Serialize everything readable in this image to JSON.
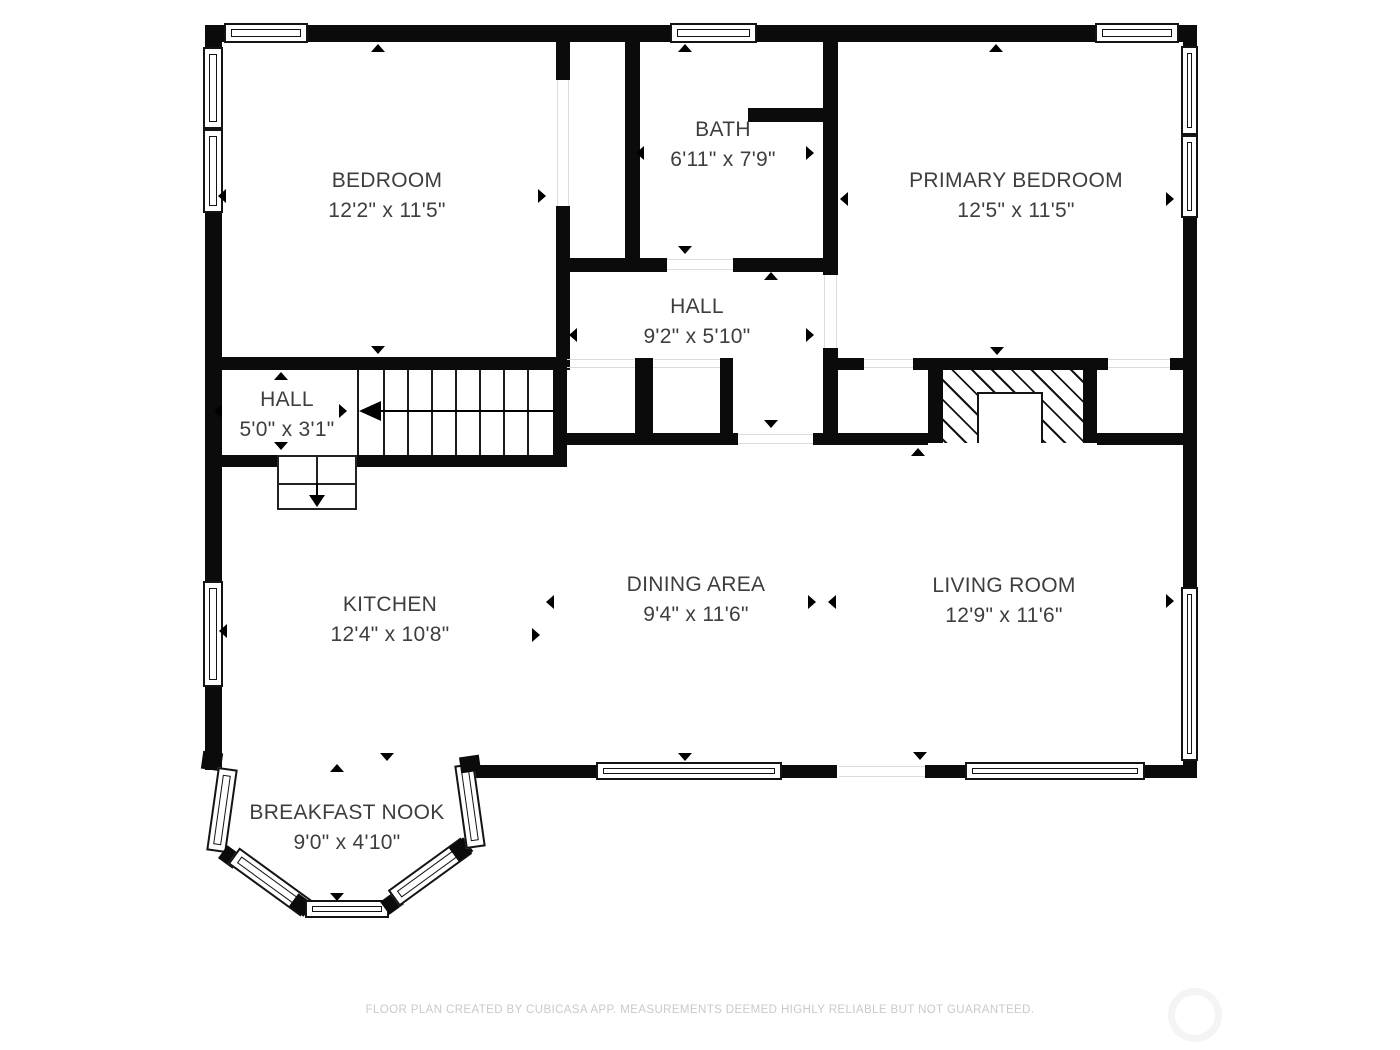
{
  "plan": {
    "type": "floor-plan",
    "creator_app": "CubiCasa"
  },
  "rooms": [
    {
      "id": "bedroom",
      "name": "BEDROOM",
      "dims": "12'2\" x 11'5\""
    },
    {
      "id": "bath",
      "name": "BATH",
      "dims": "6'11\" x 7'9\""
    },
    {
      "id": "primary-bedroom",
      "name": "PRIMARY BEDROOM",
      "dims": "12'5\" x 11'5\""
    },
    {
      "id": "hall-upper",
      "name": "HALL",
      "dims": "9'2\" x 5'10\""
    },
    {
      "id": "hall-stairs",
      "name": "HALL",
      "dims": "5'0\" x 3'1\""
    },
    {
      "id": "kitchen",
      "name": "KITCHEN",
      "dims": "12'4\" x 10'8\""
    },
    {
      "id": "dining-area",
      "name": "DINING AREA",
      "dims": "9'4\" x 11'6\""
    },
    {
      "id": "living-room",
      "name": "LIVING ROOM",
      "dims": "12'9\" x 11'6\""
    },
    {
      "id": "breakfast-nook",
      "name": "BREAKFAST NOOK",
      "dims": "9'0\" x 4'10\""
    }
  ],
  "footer": {
    "disclaimer": "FLOOR PLAN CREATED BY CUBICASA APP. MEASUREMENTS DEEMED HIGHLY RELIABLE BUT NOT GUARANTEED."
  },
  "watermark": {
    "icon": "circle-logo"
  },
  "colors": {
    "wall": "#0b0b0b",
    "room_text": "#3e3e3e",
    "footer_text": "#c9c9c9",
    "threshold": "#dcdcdc",
    "watermark_ring": "#f4f4f4",
    "background": "#ffffff"
  }
}
